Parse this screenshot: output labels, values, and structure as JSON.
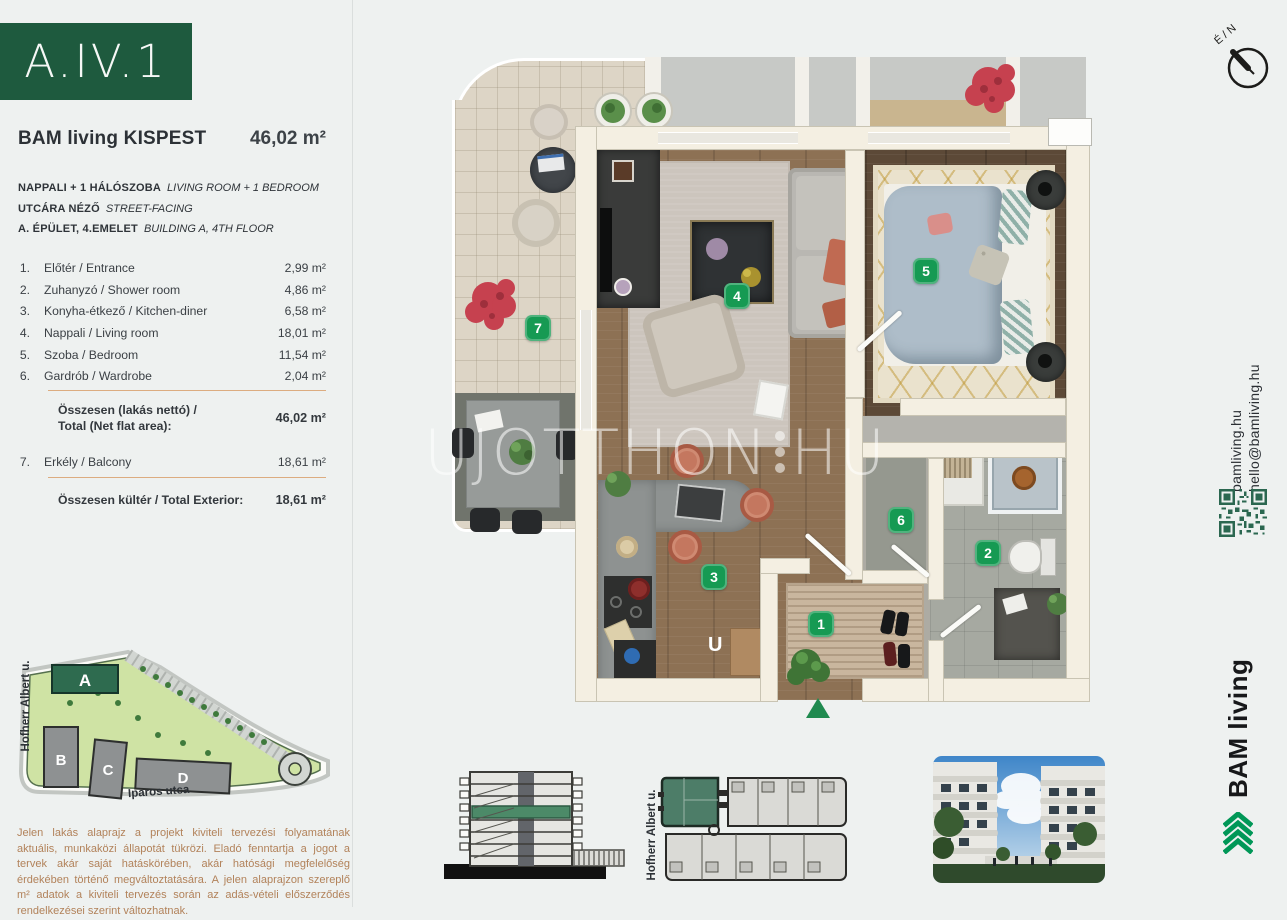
{
  "header": {
    "unit_id": "A.IV.1",
    "project": "BAM living KISPEST",
    "total_area": "46,02 m²"
  },
  "subtitle": [
    {
      "hu": "NAPPALI + 1 HÁLÓSZOBA",
      "en": "LIVING ROOM + 1 BEDROOM"
    },
    {
      "hu": "UTCÁRA NÉZŐ",
      "en": "STREET-FACING"
    },
    {
      "hu": "A. ÉPÜLET, 4.EMELET",
      "en": "BUILDING A, 4TH FLOOR"
    }
  ],
  "rooms": [
    {
      "num": "1.",
      "name": "Előtér / Entrance",
      "area": "2,99 m²"
    },
    {
      "num": "2.",
      "name": "Zuhanyzó / Shower room",
      "area": "4,86 m²"
    },
    {
      "num": "3.",
      "name": "Konyha-étkező / Kitchen-diner",
      "area": "6,58 m²"
    },
    {
      "num": "4.",
      "name": "Nappali / Living room",
      "area": "18,01 m²"
    },
    {
      "num": "5.",
      "name": "Szoba / Bedroom",
      "area": "11,54 m²"
    },
    {
      "num": "6.",
      "name": "Gardrób / Wardrobe",
      "area": "2,04 m²"
    }
  ],
  "total_net": {
    "label_line1": "Összesen (lakás nettó) /",
    "label_line2": "Total (Net flat area):",
    "area": "46,02 m²"
  },
  "balcony_row": {
    "num": "7.",
    "name": "Erkély / Balcony",
    "area": "18,61 m²"
  },
  "total_ext": {
    "label": "Összesen kültér / Total Exterior:",
    "area": "18,61 m²"
  },
  "site_map": {
    "street_left": "Hofherr Albert u.",
    "street_bottom": "Iparos utca",
    "buildings": [
      "A",
      "B",
      "C",
      "D"
    ]
  },
  "disclaimer": "Jelen lakás alaprajz a projekt kiviteli tervezési folyamatának aktuális, munkaközi állapotát tükrözi. Eladó fenntartja a jogot a tervek akár saját hatáskörében, akár hatósági megfelelőség érdekében történő megváltoztatására. A jelen alaprajzon szereplő m² adatok a kiviteli tervezés során az adás-vételi előszerződés rendelkezései szerint változhatnak.",
  "plan": {
    "badges": [
      "1",
      "2",
      "3",
      "4",
      "5",
      "6",
      "7"
    ],
    "watermark_part1": "UJOTTHON",
    "watermark_part2": "HU",
    "compass_label": "É / N",
    "kitchen_letter": "U"
  },
  "footer": {
    "elevation_street": "Hofherr Albert u."
  },
  "rail": {
    "web": "bamliving.hu",
    "email": "hello@bamliving.hu",
    "brand": "BAM living"
  },
  "colors": {
    "brand_green_dark": "#1e5a3e",
    "badge_green": "#169a53",
    "divider_tan": "#dcac80",
    "disclaimer_tan": "#b2825a",
    "logo_green": "#009757"
  }
}
